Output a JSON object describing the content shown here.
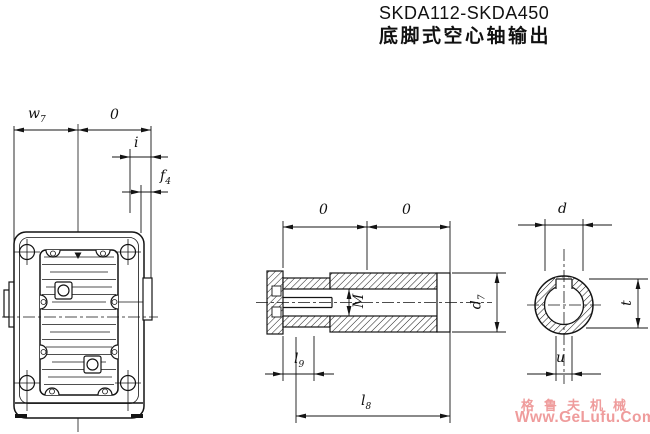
{
  "title": {
    "model_range": "SKDA112-SKDA450",
    "subtitle": "底脚式空心轴输出"
  },
  "front_view": {
    "w7_base": "w",
    "w7_sub": "7",
    "o": "0",
    "i": "i",
    "f4_base": "f",
    "f4_sub": "4"
  },
  "section_view": {
    "o_left": "0",
    "o_right": "0",
    "m": "M",
    "d7_base": "d",
    "d7_sub": "7",
    "l9_base": "l",
    "l9_sub": "9",
    "l8_base": "l",
    "l8_sub": "8"
  },
  "end_view": {
    "d": "d",
    "t": "t",
    "u": "u"
  },
  "watermark": {
    "brand": "格鲁夫机械",
    "site": "Www.GeLufu.Com",
    "color": "#ef9c9c"
  }
}
